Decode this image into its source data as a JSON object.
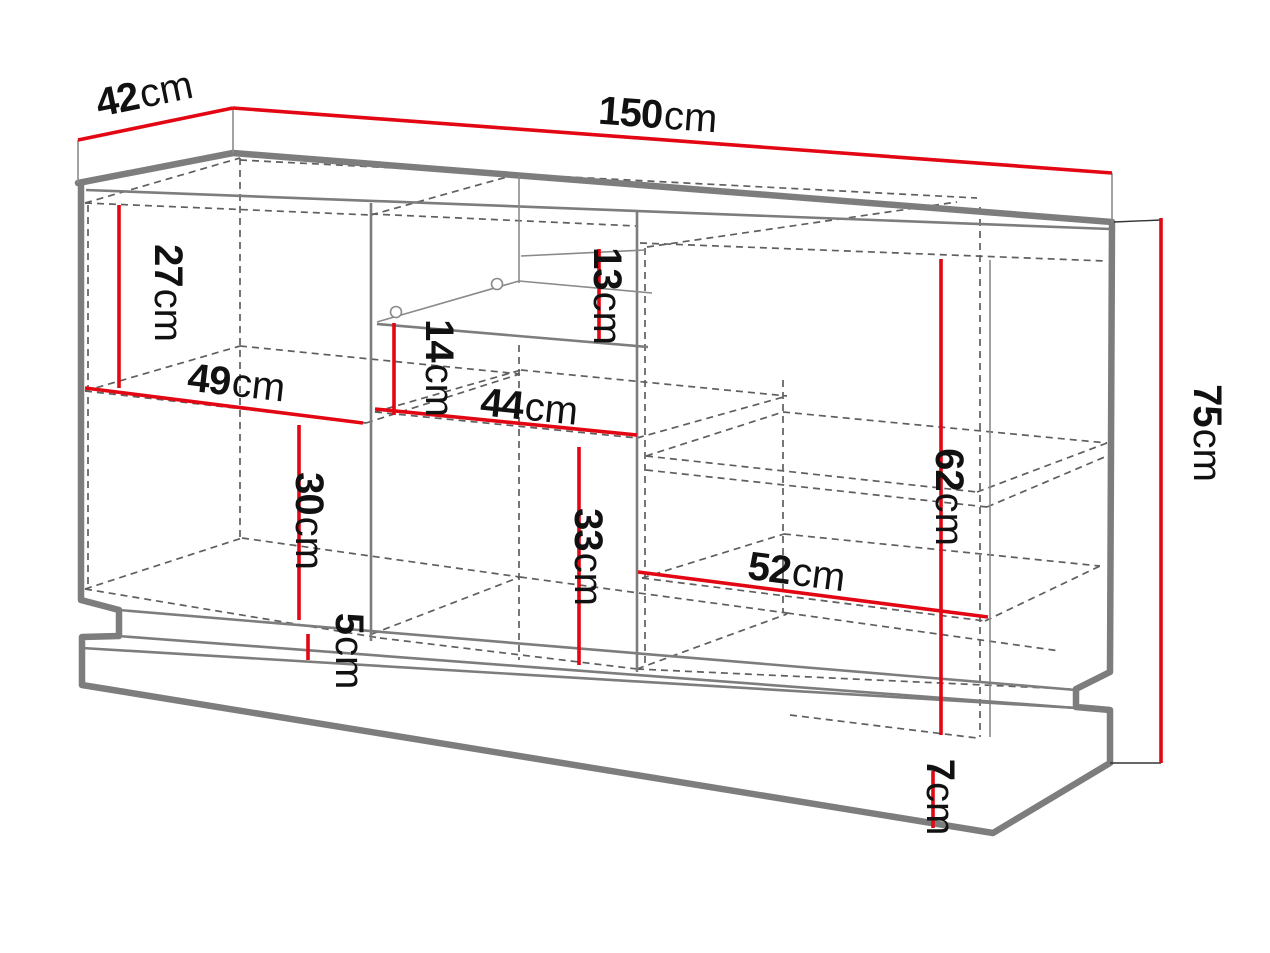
{
  "diagram": {
    "kind": "furniture-dimension-drawing",
    "subject": "sideboard-cabinet-perspective"
  },
  "colors": {
    "dimension": "#e30613",
    "outline": "#7d7d7d",
    "hidden": "#5f5f5f",
    "text": "#111111",
    "background": "#ffffff"
  },
  "dimensions": {
    "depth": {
      "value": "42",
      "unit": "cm"
    },
    "width": {
      "value": "150",
      "unit": "cm"
    },
    "height": {
      "value": "75",
      "unit": "cm"
    },
    "left_top_height": {
      "value": "27",
      "unit": "cm"
    },
    "left_width": {
      "value": "49",
      "unit": "cm"
    },
    "left_bottom_height": {
      "value": "30",
      "unit": "cm"
    },
    "plinth_recess": {
      "value": "5",
      "unit": "cm"
    },
    "glass_shelf_gap": {
      "value": "13",
      "unit": "cm"
    },
    "mid_shelf_gap": {
      "value": "14",
      "unit": "cm"
    },
    "mid_width": {
      "value": "44",
      "unit": "cm"
    },
    "mid_bottom_height": {
      "value": "33",
      "unit": "cm"
    },
    "right_height": {
      "value": "62",
      "unit": "cm"
    },
    "right_width": {
      "value": "52",
      "unit": "cm"
    },
    "base_height": {
      "value": "7",
      "unit": "cm"
    }
  }
}
